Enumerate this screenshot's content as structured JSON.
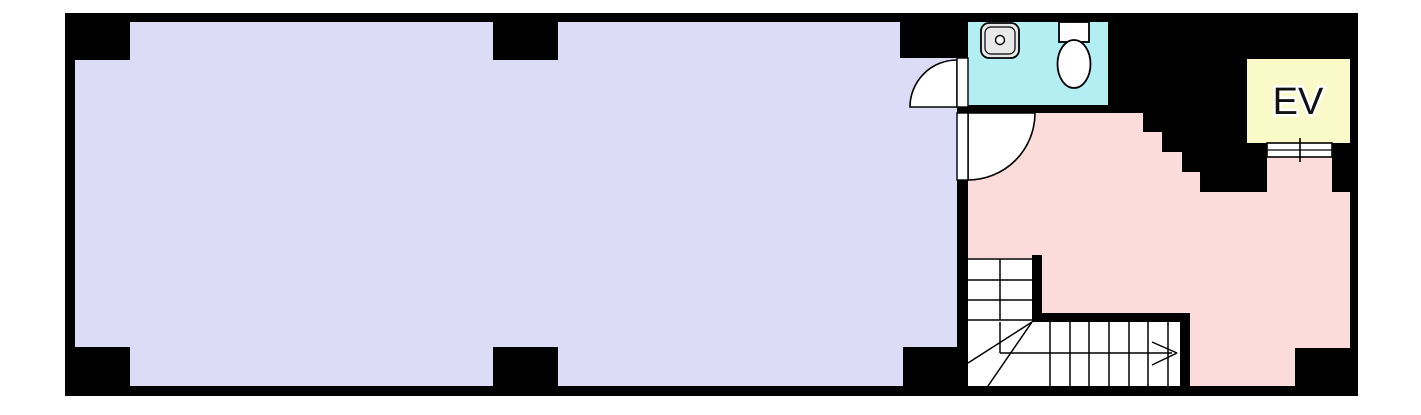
{
  "floor_plan": {
    "elevator": {
      "label": "EV"
    },
    "colors": {
      "wall": "#000000",
      "main_room": "#dcdcf6",
      "hallway": "#fcdbdb",
      "restroom": "#b3eef2",
      "elevator": "#fafac8",
      "fixture": "#e9e9e9",
      "line": "#000000",
      "background": "#ffffff"
    },
    "elements": {
      "rooms": [
        "main-room",
        "hallway",
        "restroom",
        "elevator-shaft"
      ],
      "fixtures": [
        "sink",
        "toilet",
        "staircase",
        "swing-door",
        "swing-door",
        "elevator-door"
      ],
      "structure": [
        "outer-wall",
        "columns",
        "stepped-wall",
        "stair-enclosure-wall"
      ]
    }
  }
}
